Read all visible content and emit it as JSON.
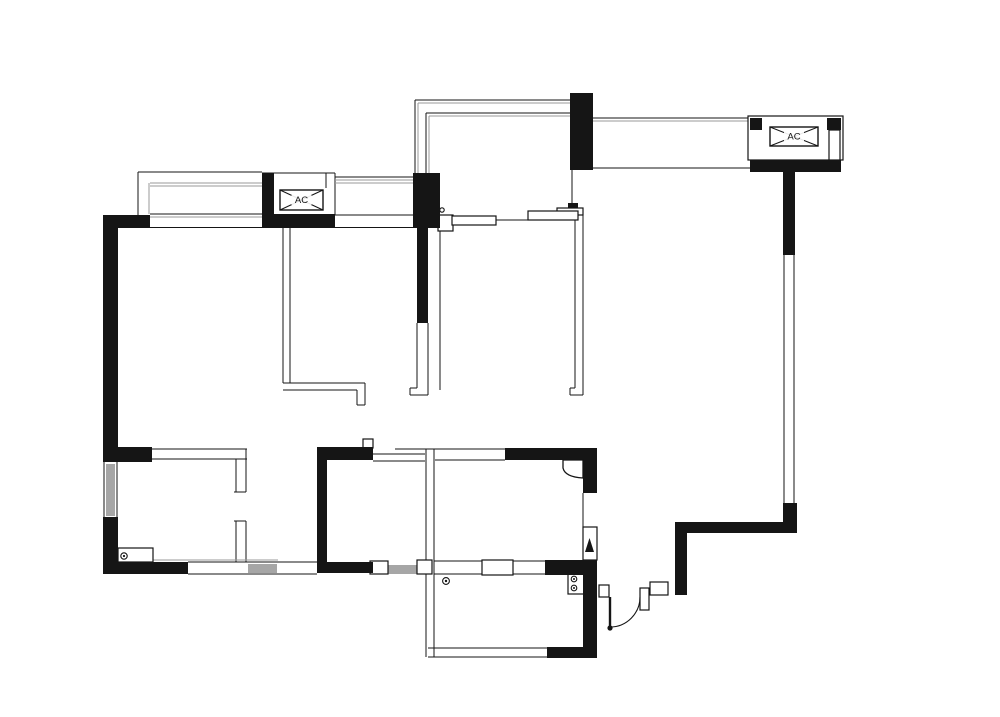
{
  "page": {
    "background": "#ffffff"
  },
  "plan": {
    "width": 1000,
    "height": 717,
    "colors": {
      "ink": "#151515",
      "glaze": "#9a9a9a",
      "window_fill": "#a6a6a6",
      "paper": "#ffffff"
    },
    "labels": {
      "ac_left": "AC",
      "ac_right": "AC"
    },
    "solid_walls": [
      [
        103,
        215,
        15,
        247
      ],
      [
        103,
        215,
        47,
        13
      ],
      [
        103,
        447,
        49,
        15
      ],
      [
        103,
        517,
        15,
        57
      ],
      [
        103,
        562,
        85,
        12
      ],
      [
        262,
        173,
        12,
        42
      ],
      [
        262,
        214,
        73,
        14
      ],
      [
        413,
        173,
        27,
        55
      ],
      [
        417,
        227,
        11,
        96
      ],
      [
        570,
        93,
        23,
        77
      ],
      [
        750,
        118,
        12,
        12
      ],
      [
        827,
        118,
        14,
        12
      ],
      [
        750,
        160,
        91,
        12
      ],
      [
        783,
        172,
        12,
        83
      ],
      [
        783,
        503,
        14,
        30
      ],
      [
        675,
        522,
        122,
        11
      ],
      [
        675,
        533,
        12,
        62
      ],
      [
        505,
        448,
        92,
        12
      ],
      [
        583,
        448,
        14,
        45
      ],
      [
        583,
        573,
        14,
        84
      ],
      [
        545,
        560,
        52,
        15
      ],
      [
        547,
        647,
        50,
        11
      ],
      [
        317,
        447,
        56,
        13
      ],
      [
        317,
        447,
        10,
        126
      ],
      [
        317,
        562,
        56,
        11
      ],
      [
        568,
        203,
        10,
        5
      ]
    ],
    "lines": [
      [
        138,
        172,
        262,
        172
      ],
      [
        138,
        172,
        138,
        215
      ],
      [
        335,
        177,
        413,
        177
      ],
      [
        150,
        214,
        262,
        214
      ],
      [
        335,
        215,
        413,
        215
      ],
      [
        118,
        227.5,
        417,
        227.5
      ],
      [
        262,
        173,
        335,
        173
      ],
      [
        326,
        173,
        326,
        188
      ],
      [
        335,
        173,
        335,
        215
      ],
      [
        415,
        173,
        415,
        100
      ],
      [
        415,
        100,
        570,
        100
      ],
      [
        426,
        173,
        426,
        113
      ],
      [
        426,
        113,
        570,
        113
      ],
      [
        593,
        118,
        750,
        118
      ],
      [
        593,
        168,
        750,
        168
      ],
      [
        784,
        255,
        784,
        503
      ],
      [
        794,
        255,
        794,
        503
      ],
      [
        283,
        228,
        283,
        383
      ],
      [
        290,
        228,
        290,
        383
      ],
      [
        283,
        383,
        365,
        383
      ],
      [
        283,
        390,
        357,
        390
      ],
      [
        357,
        390,
        357,
        405
      ],
      [
        365,
        383,
        365,
        405
      ],
      [
        357,
        405,
        365,
        405
      ],
      [
        417,
        323,
        417,
        388
      ],
      [
        428,
        323,
        428,
        395
      ],
      [
        410,
        388,
        417,
        388
      ],
      [
        410,
        388,
        410,
        395
      ],
      [
        410,
        395,
        428,
        395
      ],
      [
        575,
        215,
        575,
        388
      ],
      [
        583,
        215,
        583,
        395
      ],
      [
        570,
        388,
        575,
        388
      ],
      [
        570,
        388,
        570,
        395
      ],
      [
        570,
        395,
        583,
        395
      ],
      [
        572,
        170,
        572,
        208
      ],
      [
        440,
        228,
        440,
        390
      ],
      [
        425,
        449,
        505,
        449
      ],
      [
        435,
        460,
        505,
        460
      ],
      [
        426,
        449,
        426,
        657
      ],
      [
        434,
        449,
        434,
        657
      ],
      [
        373,
        454,
        425,
        454
      ],
      [
        373,
        461,
        425,
        461
      ],
      [
        395,
        449,
        425,
        449
      ],
      [
        188,
        562,
        317,
        562
      ],
      [
        188,
        574,
        317,
        574
      ],
      [
        434,
        561,
        545,
        561
      ],
      [
        434,
        574,
        545,
        574
      ],
      [
        428,
        648,
        547,
        648
      ],
      [
        428,
        657,
        547,
        657
      ],
      [
        152,
        449,
        247,
        449
      ],
      [
        152,
        459,
        247,
        459
      ],
      [
        236,
        459,
        236,
        492
      ],
      [
        246,
        449,
        246,
        492
      ],
      [
        234,
        492,
        246,
        492
      ],
      [
        236,
        521,
        236,
        562
      ],
      [
        246,
        521,
        246,
        562
      ],
      [
        234,
        521,
        246,
        521
      ],
      [
        104,
        462,
        104,
        517
      ],
      [
        117,
        462,
        117,
        517
      ],
      [
        583,
        493,
        583,
        527
      ],
      [
        496,
        220,
        530,
        220
      ]
    ],
    "glaze_lines": [
      [
        150,
        183,
        262,
        183
      ],
      [
        150,
        186,
        262,
        186
      ],
      [
        149,
        183,
        149,
        214
      ],
      [
        150,
        217,
        262,
        217
      ],
      [
        335,
        180,
        413,
        180
      ],
      [
        335,
        183,
        413,
        183
      ],
      [
        418,
        173,
        418,
        103
      ],
      [
        418,
        103,
        570,
        103
      ],
      [
        429,
        173,
        429,
        116
      ],
      [
        429,
        116,
        570,
        116
      ],
      [
        593,
        121,
        750,
        121
      ],
      [
        153,
        560,
        278,
        560
      ],
      [
        456,
        220,
        492,
        220
      ],
      [
        532,
        215,
        574,
        215
      ],
      [
        484,
        563,
        511,
        563
      ],
      [
        484,
        566,
        511,
        566
      ],
      [
        484,
        569,
        511,
        569
      ],
      [
        484,
        572,
        511,
        572
      ],
      [
        566,
        462,
        581,
        475
      ]
    ],
    "window_fills": [
      [
        248,
        564,
        29,
        9
      ],
      [
        388,
        565,
        29,
        9
      ],
      [
        106,
        464,
        9,
        52
      ]
    ],
    "white_boxes": [
      [
        748,
        116,
        95,
        44,
        "ac-enclosure-frame"
      ],
      [
        829,
        130,
        11,
        30,
        "ac-enclosure-side-panel"
      ],
      [
        557,
        208,
        26,
        7,
        "sliding-door-track-cap"
      ],
      [
        438,
        215,
        15,
        16,
        "sliding-door-end-frame"
      ],
      [
        452,
        216,
        44,
        9,
        "sliding-door-panel-1"
      ],
      [
        528,
        211,
        50,
        9,
        "sliding-door-panel-2"
      ],
      [
        363,
        439,
        10,
        9,
        "wall-nib"
      ],
      [
        370,
        561,
        18,
        13,
        "window-jamb-left"
      ],
      [
        417,
        560,
        15,
        14,
        "window-jamb-right"
      ],
      [
        482,
        560,
        31,
        15,
        "kitchen-pass-window"
      ],
      [
        118,
        548,
        35,
        14,
        "fixture-cabinet"
      ],
      [
        568,
        572,
        16,
        22,
        "stove-fixture"
      ],
      [
        583,
        527,
        14,
        33,
        "gas-meter-niche"
      ],
      [
        599,
        585,
        10,
        12,
        "entry-jamb-left"
      ],
      [
        640,
        588,
        9,
        22,
        "entry-jamb-right"
      ],
      [
        650,
        582,
        18,
        13,
        "entry-jamb-top"
      ]
    ],
    "circles": [
      [
        442,
        210,
        2.2,
        "s",
        "track-pin"
      ],
      [
        124,
        556,
        3.2,
        "s",
        "drain-symbol-left"
      ],
      [
        124,
        556,
        1.1,
        "f",
        "drain-dot-left"
      ],
      [
        446,
        581,
        3.4,
        "s",
        "floor-drain"
      ],
      [
        446,
        581,
        1.2,
        "f",
        "floor-drain-dot"
      ],
      [
        574,
        579,
        2.8,
        "s",
        "stove-burner-1"
      ],
      [
        574,
        588,
        2.8,
        "s",
        "stove-burner-2"
      ],
      [
        574,
        579,
        1.0,
        "f",
        "stove-burner-1-dot"
      ],
      [
        574,
        588,
        1.0,
        "f",
        "stove-burner-2-dot"
      ],
      [
        610,
        628,
        2.6,
        "f",
        "door-hinge-dot"
      ]
    ],
    "paths": [
      {
        "d": "M640,597 A30,30 0 0 1 610,627",
        "mode": "stroke",
        "w": 1.1,
        "name": "entry-door-arc"
      },
      {
        "d": "M610,597 L610,628",
        "mode": "stroke",
        "w": 2.4,
        "name": "entry-door-leaf"
      },
      {
        "d": "M563,460 L563,468 Q565,477 583,478 L583,460 Z",
        "mode": "both",
        "w": 1.3,
        "name": "corner-detail"
      },
      {
        "d": "M585,552 L589.5,538 L594,552 Z",
        "mode": "fill",
        "w": 1,
        "name": "gas-meter-symbol"
      }
    ],
    "ac_units": [
      {
        "x": 280,
        "y": 190,
        "w": 43,
        "h": 20,
        "label": "ac_left",
        "name": "ac-unit-top-left"
      },
      {
        "x": 770,
        "y": 127,
        "w": 48,
        "h": 19,
        "label": "ac_right",
        "name": "ac-unit-top-right"
      }
    ]
  }
}
